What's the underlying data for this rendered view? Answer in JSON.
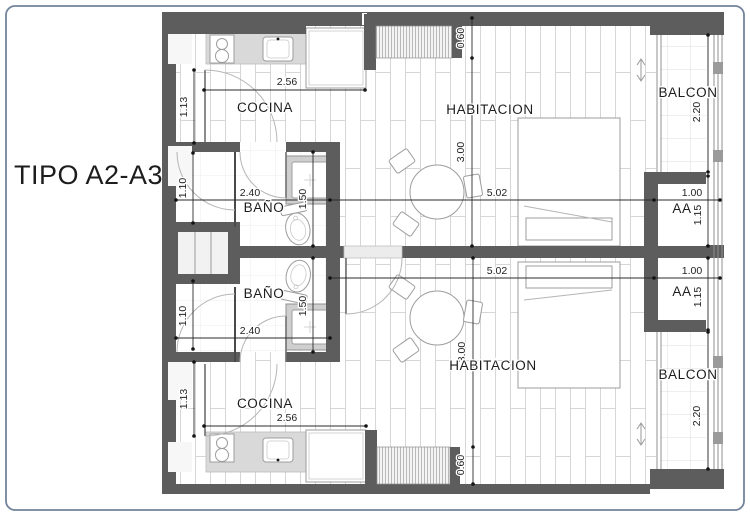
{
  "title": "TIPO A2-A3",
  "colors": {
    "wall": "#5d5d5d",
    "frame_border": "#72849b",
    "counter": "#d9d9d9",
    "dim_line": "#2b2b2b",
    "floor_line": "#d6d6d6"
  },
  "units": [
    {
      "id": "upper",
      "rooms": {
        "cocina": "COCINA",
        "bano": "BAÑO",
        "habitacion": "HABITACION",
        "balcon": "BALCON",
        "aa": "AA"
      },
      "dims": {
        "counter_width": "2.56",
        "kitchen_door": "1.13",
        "bath_width": "2.40",
        "bath_depth": "1.50",
        "shower_width": "1.10",
        "closet_depth": "0.60",
        "room_depth": "3.00",
        "room_width": "5.02",
        "aa_width": "1.00",
        "aa_depth": "1.15",
        "balcony_depth": "2.20"
      }
    },
    {
      "id": "lower",
      "rooms": {
        "cocina": "COCINA",
        "bano": "BAÑO",
        "habitacion": "HABITACION",
        "balcon": "BALCON",
        "aa": "AA"
      },
      "dims": {
        "counter_width": "2.56",
        "kitchen_door": "1.13",
        "bath_width": "2.40",
        "bath_depth": "1.50",
        "shower_width": "1.10",
        "closet_depth": "0.60",
        "room_depth": "3.00",
        "room_width": "5.02",
        "aa_width": "1.00",
        "aa_depth": "1.15",
        "balcony_depth": "2.20"
      }
    }
  ]
}
